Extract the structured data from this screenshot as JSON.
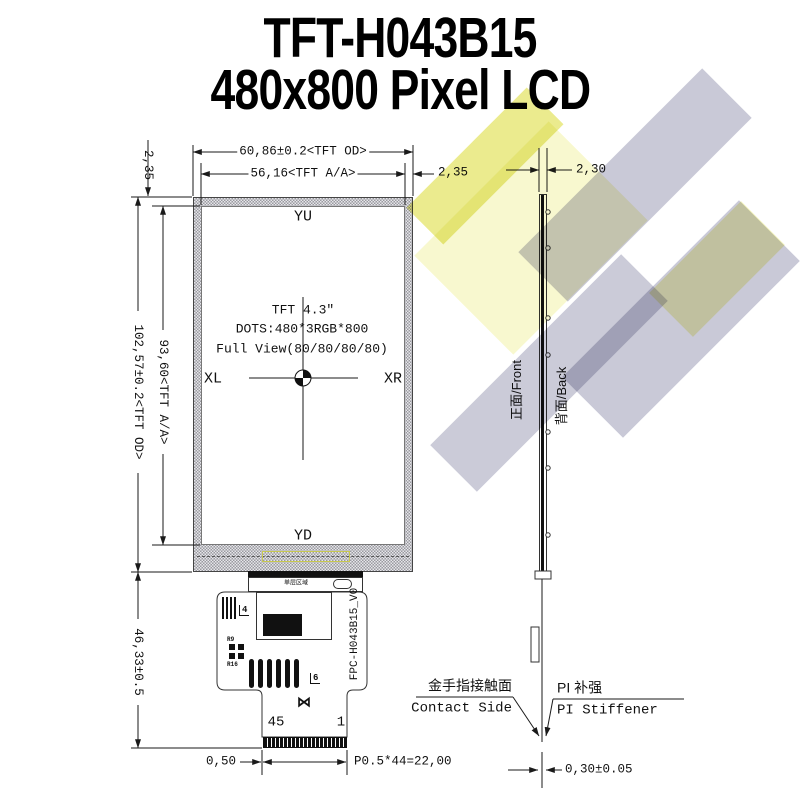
{
  "title": {
    "line1": "TFT-H043B15",
    "line2": "480x800 Pixel LCD"
  },
  "front": {
    "yu": "YU",
    "yd": "YD",
    "xl": "XL",
    "xr": "XR",
    "info1": "TFT 4.3″",
    "info2": "DOTS:480*3RGB*800",
    "info3": "Full View(80/80/80/80)",
    "tab": "单层区域"
  },
  "dims": {
    "od_w": "60,86±0.2<TFT OD>",
    "aa_w": "56,16<TFT A/A>",
    "bezel_r": "2,35",
    "bezel_t": "2,35",
    "aa_h": "93,60<TFT A/A>",
    "od_h": "102,57±0.2<TFT OD>",
    "fpc_len": "46,33±0.5",
    "thickness": "2,30",
    "margin": "0,50",
    "pitch": "P0.5*44=22,00",
    "fpc_thk": "0,30±0.05"
  },
  "side": {
    "front": "正面/Front",
    "back": "背面/Back"
  },
  "fpc": {
    "pn": "FPC-H043B15_V0",
    "pin_last": "45",
    "pin_first": "1",
    "mark4": "4",
    "mark6": "6",
    "r9": "R9",
    "r16": "R16",
    "logo": "⋈"
  },
  "callout": {
    "contact_cn": "金手指接触面",
    "contact_en": "Contact Side",
    "stiffener_cn": "PI 补强",
    "stiffener_en": "PI Stiffener"
  },
  "colors": {
    "line": "#1a1a1a",
    "hatch_dark": "#9a9aa0",
    "hatch_light": "#e6e6ea",
    "watermark_yellow": "#ebeb8e",
    "watermark_gray": "#c9c9d7",
    "highlight_yellow": "#c8c850"
  }
}
